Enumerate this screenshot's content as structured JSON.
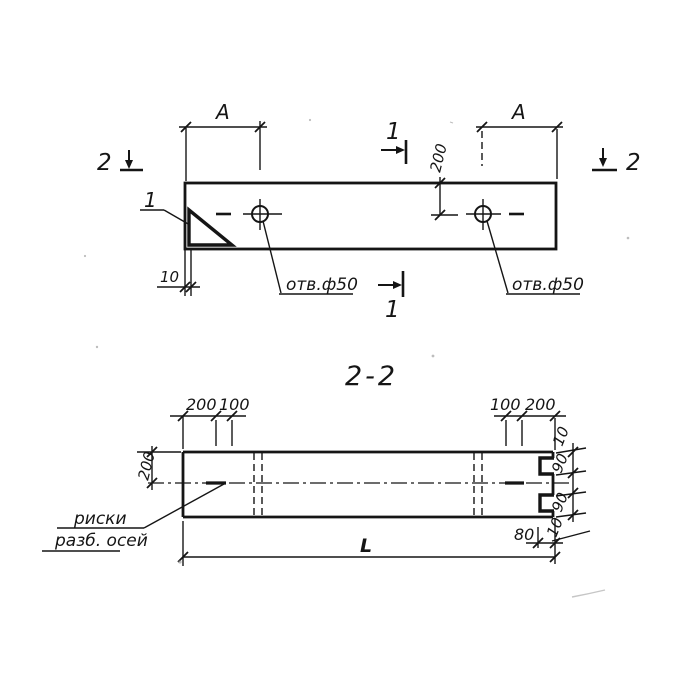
{
  "colors": {
    "ink": "#151515",
    "paper": "#ffffff"
  },
  "plan_view": {
    "dim_a_left": "А",
    "dim_a_right": "А",
    "dim_depth": "200",
    "dim_wall": "10",
    "hole_left": "отв.ф50",
    "hole_right": "отв.ф50",
    "callout_corner": "1",
    "marker_1_top": "1",
    "marker_1_bottom": "1",
    "marker_2_left": "2",
    "marker_2_right": "2"
  },
  "section_view": {
    "title": "2-2",
    "dim_top_left_1": "200",
    "dim_top_left_2": "100",
    "dim_top_right_1": "100",
    "dim_top_right_2": "200",
    "dim_height": "200",
    "dim_edge_top_1": "10",
    "dim_edge_top_2": "90",
    "dim_edge_bottom_1": "90",
    "dim_edge_bottom_2": "10",
    "dim_notch": "80",
    "dim_length": "L",
    "note_line1": "риски",
    "note_line2": "разб. осей"
  }
}
